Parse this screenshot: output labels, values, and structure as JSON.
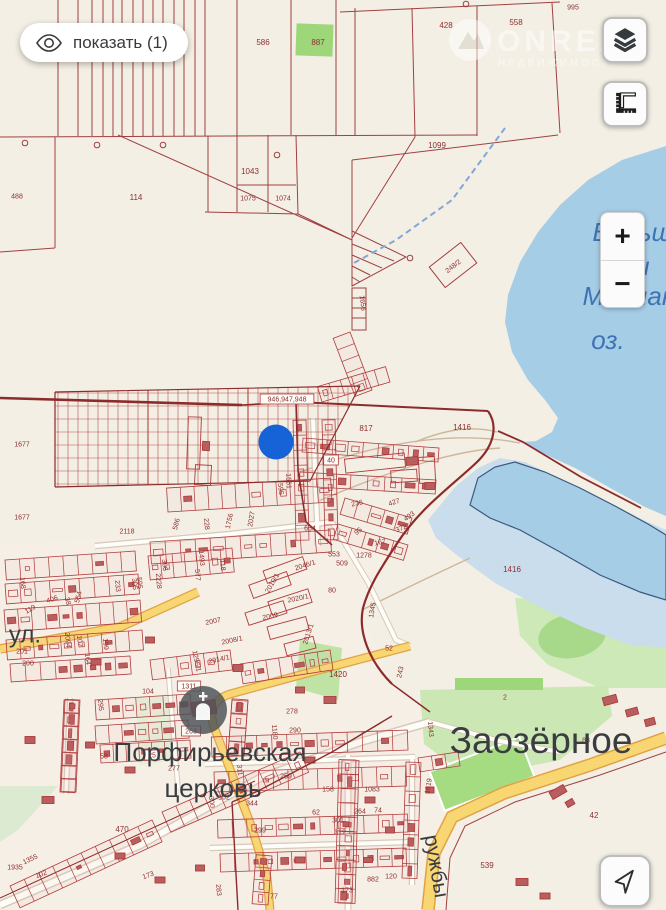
{
  "ui": {
    "show_button": {
      "label": "показать (1)"
    },
    "zoom_in": "+",
    "zoom_out": "−",
    "watermark": {
      "line1": "ONREAL",
      "line2": "НЕДВИЖИМОСТЬ"
    }
  },
  "colors": {
    "land": "#f3efe4",
    "water": "#a6cde6",
    "marsh": "#c9ddec",
    "parcel_line": "#a04040",
    "boundary": "#8c2b2b",
    "road_yellow": "#f8d671",
    "label_red": "#8d2f2f",
    "label_place": "#3a3d40",
    "label_water": "#3e74b4",
    "marker_blue": "#1563d6",
    "green": "#cde9b8"
  },
  "map_labels": [
    {
      "t": "428",
      "x": 446,
      "y": 25
    },
    {
      "t": "558",
      "x": 516,
      "y": 22
    },
    {
      "t": "995",
      "x": 573,
      "y": 7,
      "s": 7
    },
    {
      "t": "586",
      "x": 263,
      "y": 42
    },
    {
      "t": "887",
      "x": 318,
      "y": 42
    },
    {
      "t": "488",
      "x": 17,
      "y": 196,
      "s": 7
    },
    {
      "t": "114",
      "x": 136,
      "y": 197
    },
    {
      "t": "1043",
      "x": 250,
      "y": 171
    },
    {
      "t": "1075",
      "x": 248,
      "y": 198,
      "s": 7
    },
    {
      "t": "1074",
      "x": 283,
      "y": 198,
      "s": 7
    },
    {
      "t": "1099",
      "x": 437,
      "y": 145
    },
    {
      "t": "248/2",
      "x": 453,
      "y": 266,
      "r": -38,
      "s": 7
    },
    {
      "t": "1656",
      "x": 363,
      "y": 303,
      "r": 83,
      "s": 7
    },
    {
      "t": "946,947,948",
      "x": 287,
      "y": 399,
      "s": 7,
      "box": 1
    },
    {
      "t": "817",
      "x": 366,
      "y": 428
    },
    {
      "t": "1416",
      "x": 462,
      "y": 427
    },
    {
      "t": "1416",
      "x": 512,
      "y": 569
    },
    {
      "t": "40",
      "x": 331,
      "y": 460,
      "s": 7,
      "box": 1
    },
    {
      "t": "1561",
      "x": 289,
      "y": 481,
      "r": 88,
      "s": 7
    },
    {
      "t": "1677",
      "x": 22,
      "y": 444,
      "s": 7
    },
    {
      "t": "1677",
      "x": 22,
      "y": 517,
      "s": 7
    },
    {
      "t": "2118",
      "x": 127,
      "y": 531,
      "s": 7
    },
    {
      "t": "586",
      "x": 176,
      "y": 524,
      "r": -75,
      "s": 7
    },
    {
      "t": "228",
      "x": 207,
      "y": 524,
      "r": 85,
      "s": 7
    },
    {
      "t": "1756",
      "x": 229,
      "y": 521,
      "r": -78,
      "s": 7
    },
    {
      "t": "2027",
      "x": 251,
      "y": 519,
      "r": -80,
      "s": 7
    },
    {
      "t": "654",
      "x": 310,
      "y": 528,
      "s": 7
    },
    {
      "t": "595",
      "x": 281,
      "y": 489,
      "r": 85,
      "s": 7
    },
    {
      "t": "236",
      "x": 357,
      "y": 503,
      "r": -12,
      "s": 7
    },
    {
      "t": "427",
      "x": 394,
      "y": 502,
      "r": -18,
      "s": 7
    },
    {
      "t": "493",
      "x": 409,
      "y": 516,
      "r": -35,
      "s": 7
    },
    {
      "t": "95",
      "x": 358,
      "y": 531,
      "r": -40,
      "s": 7
    },
    {
      "t": "372",
      "x": 401,
      "y": 528,
      "r": -20,
      "s": 7
    },
    {
      "t": "167",
      "x": 380,
      "y": 542,
      "r": -12,
      "s": 7
    },
    {
      "t": "553",
      "x": 334,
      "y": 554,
      "s": 7
    },
    {
      "t": "1278",
      "x": 364,
      "y": 555,
      "s": 7
    },
    {
      "t": "509",
      "x": 342,
      "y": 563,
      "s": 7
    },
    {
      "t": "80",
      "x": 332,
      "y": 590,
      "s": 7
    },
    {
      "t": "1345",
      "x": 372,
      "y": 610,
      "r": -80,
      "s": 7
    },
    {
      "t": "2046/1",
      "x": 305,
      "y": 565,
      "r": -18,
      "s": 7
    },
    {
      "t": "2010/1",
      "x": 272,
      "y": 583,
      "r": -60,
      "s": 7
    },
    {
      "t": "2020/1",
      "x": 298,
      "y": 598,
      "r": -12,
      "s": 7
    },
    {
      "t": "2009",
      "x": 270,
      "y": 616,
      "r": -12,
      "s": 7
    },
    {
      "t": "2013/1",
      "x": 308,
      "y": 634,
      "r": -72,
      "s": 7
    },
    {
      "t": "2007",
      "x": 213,
      "y": 621,
      "r": -12,
      "s": 7
    },
    {
      "t": "2008/1",
      "x": 232,
      "y": 640,
      "r": -12,
      "s": 7
    },
    {
      "t": "2014/1",
      "x": 219,
      "y": 659,
      "r": -12,
      "s": 7
    },
    {
      "t": "1296/1",
      "x": 197,
      "y": 661,
      "r": 78,
      "s": 7
    },
    {
      "t": "306",
      "x": 165,
      "y": 565,
      "r": 85,
      "s": 7
    },
    {
      "t": "2228",
      "x": 159,
      "y": 581,
      "r": 85,
      "s": 7
    },
    {
      "t": "577",
      "x": 198,
      "y": 575,
      "r": 85,
      "s": 7
    },
    {
      "t": "1493",
      "x": 202,
      "y": 558,
      "r": 85,
      "s": 7
    },
    {
      "t": "118",
      "x": 223,
      "y": 565,
      "r": 85,
      "s": 7
    },
    {
      "t": "595",
      "x": 140,
      "y": 583,
      "r": 85,
      "s": 7
    },
    {
      "t": "168",
      "x": 23,
      "y": 583,
      "r": 85,
      "s": 7
    },
    {
      "t": "406",
      "x": 52,
      "y": 599,
      "r": -20,
      "s": 7
    },
    {
      "t": "38",
      "x": 68,
      "y": 601,
      "r": 75,
      "s": 7
    },
    {
      "t": "554",
      "x": 78,
      "y": 597,
      "r": -75,
      "s": 7
    },
    {
      "t": "233",
      "x": 118,
      "y": 586,
      "r": 85,
      "s": 7
    },
    {
      "t": "305",
      "x": 135,
      "y": 584,
      "r": 85,
      "s": 7
    },
    {
      "t": "119",
      "x": 30,
      "y": 609,
      "r": -30,
      "s": 7
    },
    {
      "t": "52",
      "x": 389,
      "y": 648,
      "s": 7
    },
    {
      "t": "1420",
      "x": 338,
      "y": 674
    },
    {
      "t": "243",
      "x": 400,
      "y": 672,
      "r": -78,
      "s": 7
    },
    {
      "t": "2",
      "x": 505,
      "y": 697,
      "s": 7
    },
    {
      "t": "107",
      "x": 80,
      "y": 641,
      "r": 85,
      "s": 7
    },
    {
      "t": "164",
      "x": 88,
      "y": 659,
      "r": 85,
      "s": 7
    },
    {
      "t": "199",
      "x": 106,
      "y": 644,
      "r": 85,
      "s": 7
    },
    {
      "t": "2094",
      "x": 68,
      "y": 640,
      "r": 85,
      "s": 7
    },
    {
      "t": "201",
      "x": 22,
      "y": 651,
      "s": 7
    },
    {
      "t": "200",
      "x": 28,
      "y": 663,
      "s": 7
    },
    {
      "t": "104",
      "x": 148,
      "y": 691,
      "s": 7
    },
    {
      "t": "1311",
      "x": 189,
      "y": 686,
      "s": 7,
      "box": 1
    },
    {
      "t": "263",
      "x": 191,
      "y": 731,
      "s": 7,
      "box": 1
    },
    {
      "t": "25",
      "x": 152,
      "y": 755,
      "s": 7,
      "box": 1
    },
    {
      "t": "277",
      "x": 174,
      "y": 768,
      "s": 7
    },
    {
      "t": "53",
      "x": 104,
      "y": 756,
      "s": 7
    },
    {
      "t": "295",
      "x": 101,
      "y": 705,
      "r": 85,
      "s": 7
    },
    {
      "t": "278",
      "x": 292,
      "y": 711,
      "s": 7
    },
    {
      "t": "290",
      "x": 295,
      "y": 730,
      "s": 7
    },
    {
      "t": "1180",
      "x": 275,
      "y": 732,
      "r": 85,
      "s": 7
    },
    {
      "t": "311",
      "x": 240,
      "y": 770,
      "r": 85,
      "s": 7
    },
    {
      "t": "259",
      "x": 286,
      "y": 776,
      "s": 7
    },
    {
      "t": "158",
      "x": 328,
      "y": 789,
      "s": 7
    },
    {
      "t": "1083",
      "x": 372,
      "y": 789,
      "s": 7
    },
    {
      "t": "300",
      "x": 212,
      "y": 802,
      "r": 85,
      "s": 7
    },
    {
      "t": "162",
      "x": 224,
      "y": 797,
      "s": 7
    },
    {
      "t": "344",
      "x": 252,
      "y": 803,
      "s": 7
    },
    {
      "t": "62",
      "x": 316,
      "y": 812,
      "s": 7
    },
    {
      "t": "301",
      "x": 338,
      "y": 820,
      "s": 7
    },
    {
      "t": "264",
      "x": 360,
      "y": 811,
      "s": 7
    },
    {
      "t": "74",
      "x": 378,
      "y": 810,
      "s": 7
    },
    {
      "t": "312",
      "x": 340,
      "y": 832,
      "s": 7
    },
    {
      "t": "299",
      "x": 260,
      "y": 830,
      "s": 7
    },
    {
      "t": "882",
      "x": 373,
      "y": 879,
      "s": 7
    },
    {
      "t": "120",
      "x": 391,
      "y": 876,
      "s": 7
    },
    {
      "t": "77",
      "x": 274,
      "y": 896,
      "s": 7
    },
    {
      "t": "173",
      "x": 347,
      "y": 890,
      "s": 7
    },
    {
      "t": "283",
      "x": 219,
      "y": 890,
      "r": 85,
      "s": 7
    },
    {
      "t": "1619",
      "x": 428,
      "y": 786,
      "r": -80,
      "s": 7
    },
    {
      "t": "1343",
      "x": 431,
      "y": 729,
      "r": 85,
      "s": 7
    },
    {
      "t": "88",
      "x": 586,
      "y": 740,
      "s": 7
    },
    {
      "t": "539",
      "x": 487,
      "y": 865
    },
    {
      "t": "42",
      "x": 594,
      "y": 815
    },
    {
      "t": "299",
      "x": 618,
      "y": 868,
      "r": 85,
      "s": 7
    },
    {
      "t": "470",
      "x": 122,
      "y": 829
    },
    {
      "t": "1355",
      "x": 30,
      "y": 859,
      "r": -25,
      "s": 7
    },
    {
      "t": "102",
      "x": 41,
      "y": 874,
      "r": -20,
      "s": 7
    },
    {
      "t": "173",
      "x": 148,
      "y": 875,
      "r": -20,
      "s": 7
    },
    {
      "t": "1935",
      "x": 15,
      "y": 867,
      "s": 7
    },
    {
      "t": "ул.",
      "x": 25,
      "y": 634,
      "s": 24,
      "c": "place"
    },
    {
      "t": "Заозёрное",
      "x": 541,
      "y": 740,
      "s": 37,
      "c": "place"
    },
    {
      "t": "Порфирьевская",
      "x": 210,
      "y": 752,
      "s": 26,
      "c": "place"
    },
    {
      "t": "церковь",
      "x": 213,
      "y": 788,
      "s": 26,
      "c": "place"
    },
    {
      "t": "ружбы",
      "x": 437,
      "y": 866,
      "s": 21,
      "c": "place",
      "r": 80
    },
    {
      "t": "Больши",
      "x": 640,
      "y": 232,
      "s": 26,
      "c": "blue"
    },
    {
      "t": "ы",
      "x": 640,
      "y": 266,
      "s": 26,
      "c": "blue"
    },
    {
      "t": "Мойнакско",
      "x": 648,
      "y": 296,
      "s": 26,
      "c": "blue"
    },
    {
      "t": "оз.",
      "x": 608,
      "y": 340,
      "s": 26,
      "c": "blue"
    }
  ]
}
